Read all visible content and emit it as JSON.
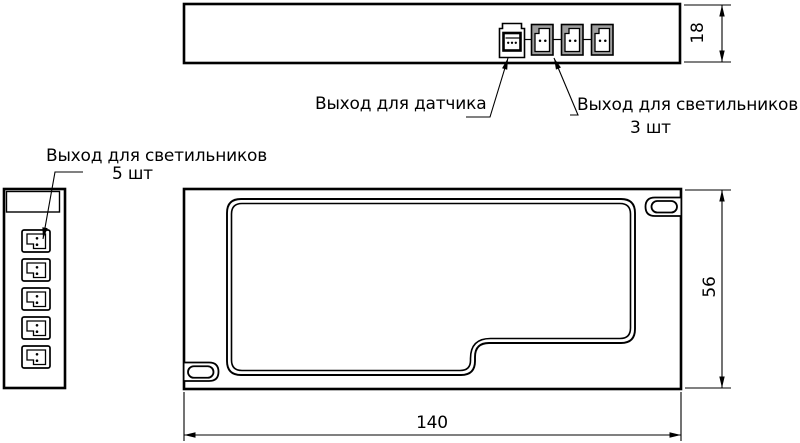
{
  "drawing": {
    "labels": {
      "sensor_output": "Выход для датчика",
      "lamp_output_top": "Выход для светильников",
      "lamp_output_top_qty": "3 шт",
      "lamp_output_side": "Выход для светильников",
      "lamp_output_side_qty": "5 шт"
    },
    "dimensions": {
      "top_view_height": "18",
      "front_view_height": "56",
      "front_view_width": "140"
    },
    "colors": {
      "line": "#000000",
      "background": "#ffffff",
      "connector_fill": "#9e9e9e"
    }
  }
}
